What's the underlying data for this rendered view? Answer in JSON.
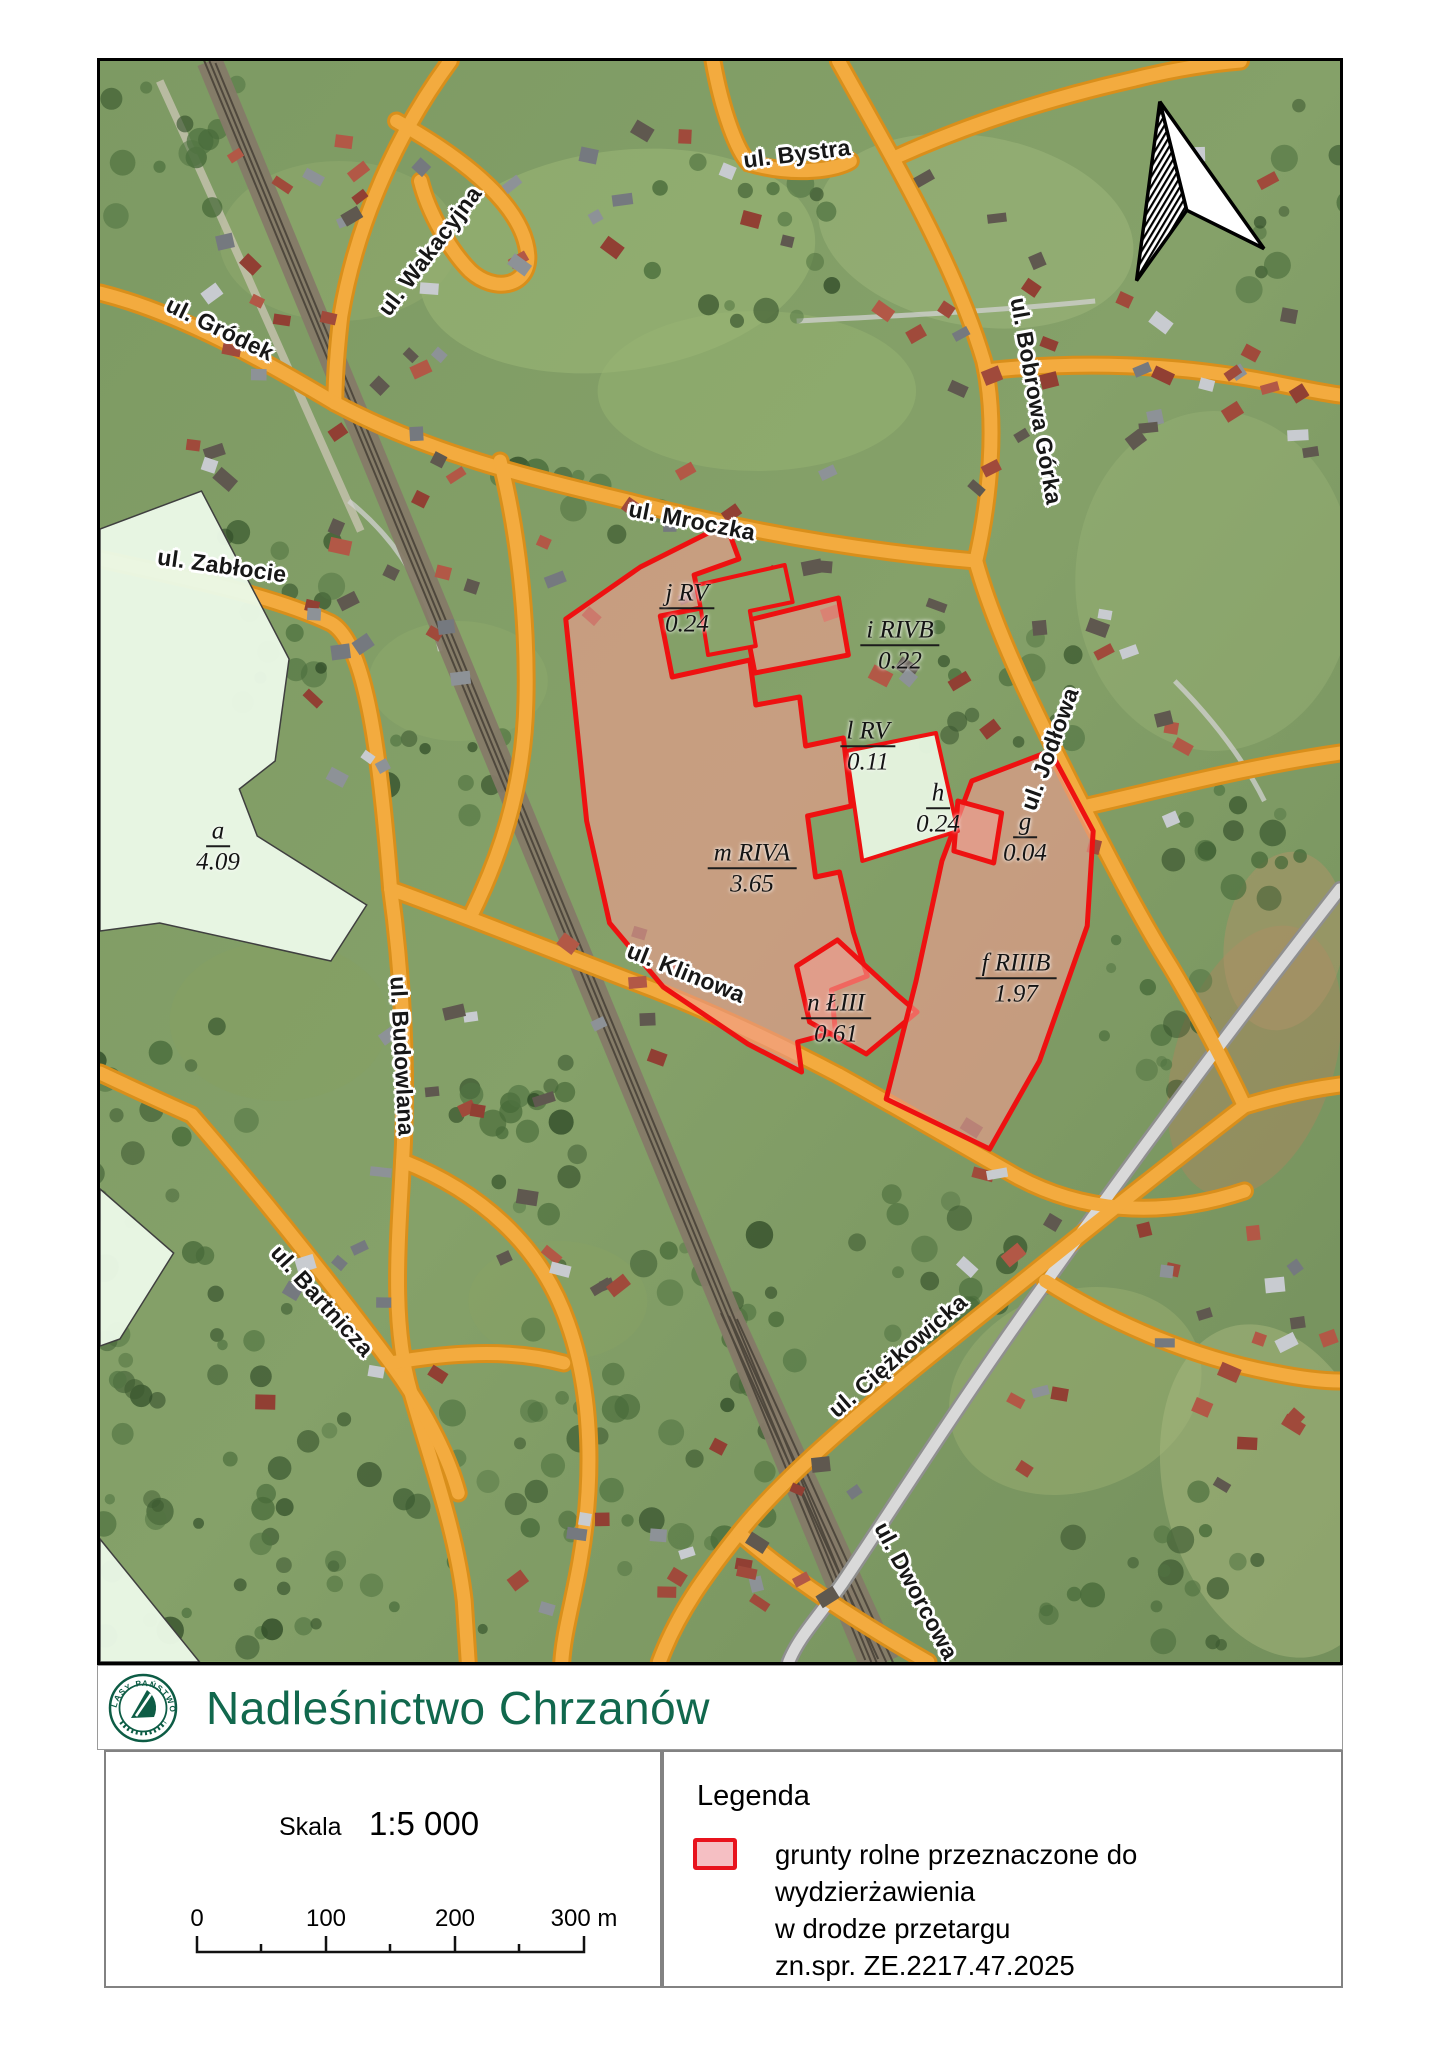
{
  "page": {
    "title_band": {
      "title": "Nadleśnictwo Chrzanów",
      "logo_ring_text": "LASY PAŃSTWOWE"
    }
  },
  "map": {
    "street_labels": [
      {
        "name": "bystra",
        "text": "ul. Bystra",
        "x": 697,
        "y": 93,
        "rot": -7
      },
      {
        "name": "wakacyjna",
        "text": "ul. Wakacyjna",
        "x": 330,
        "y": 190,
        "rot": -53
      },
      {
        "name": "grodek",
        "text": "ul. Gródek",
        "x": 120,
        "y": 268,
        "rot": 26
      },
      {
        "name": "bobrowa-gorka",
        "text": "ul. Bobrowa Górka",
        "x": 936,
        "y": 340,
        "rot": 80
      },
      {
        "name": "mroczka",
        "text": "ul. Mroczka",
        "x": 592,
        "y": 460,
        "rot": 11
      },
      {
        "name": "zablocie",
        "text": "ul. Zabłocie",
        "x": 122,
        "y": 505,
        "rot": 8
      },
      {
        "name": "jodlowa",
        "text": "ul. Jodłowa",
        "x": 950,
        "y": 688,
        "rot": -70
      },
      {
        "name": "klinowa",
        "text": "ul. Klinowa",
        "x": 586,
        "y": 912,
        "rot": 22
      },
      {
        "name": "budowlana",
        "text": "ul. Budowlana",
        "x": 302,
        "y": 995,
        "rot": 87
      },
      {
        "name": "bartnicza",
        "text": "ul. Bartnicza",
        "x": 222,
        "y": 1240,
        "rot": 48
      },
      {
        "name": "ciezkowicka",
        "text": "ul. Ciężkowicka",
        "x": 798,
        "y": 1295,
        "rot": -41
      },
      {
        "name": "dworcowa",
        "text": "ul. Dworcowa",
        "x": 816,
        "y": 1530,
        "rot": 62
      }
    ],
    "parcel_labels": [
      {
        "name": "j",
        "code": "j RV",
        "area": "0.24",
        "x": 587,
        "y": 548
      },
      {
        "name": "i",
        "code": "i RIVB",
        "area": "0.22",
        "x": 800,
        "y": 585
      },
      {
        "name": "l",
        "code": "l RV",
        "area": "0.11",
        "x": 768,
        "y": 686
      },
      {
        "name": "h",
        "code": "h",
        "area": "0.24",
        "x": 838,
        "y": 748
      },
      {
        "name": "g",
        "code": "g",
        "area": "0.04",
        "x": 925,
        "y": 777
      },
      {
        "name": "m",
        "code": "m RIVA",
        "area": "3.65",
        "x": 652,
        "y": 808
      },
      {
        "name": "n",
        "code": "n ŁIII",
        "area": "0.61",
        "x": 736,
        "y": 958
      },
      {
        "name": "f",
        "code": "f RIIIB",
        "area": "1.97",
        "x": 916,
        "y": 918
      },
      {
        "name": "a",
        "code": "a",
        "area": "4.09",
        "x": 118,
        "y": 786
      }
    ]
  },
  "scale_box": {
    "label": "Skala",
    "value": "1:5 000",
    "ticks": [
      "0",
      "100",
      "200",
      "300 m"
    ]
  },
  "legend": {
    "title": "Legenda",
    "item_lines": [
      "grunty rolne przeznaczone do wydzierżawienia",
      "w drodze przetargu",
      "zn.spr. ZE.2217.47.2025"
    ]
  },
  "colors": {
    "parcel_outline": "#ee1111",
    "parcel_fill": "#f19d90",
    "excluded_fill": "#e9f8e5",
    "road_orange": "#f3ab3f",
    "title_green": "#11684d",
    "legend_swatch_fill": "#f5bfc3",
    "legend_swatch_border": "#e8131d"
  }
}
